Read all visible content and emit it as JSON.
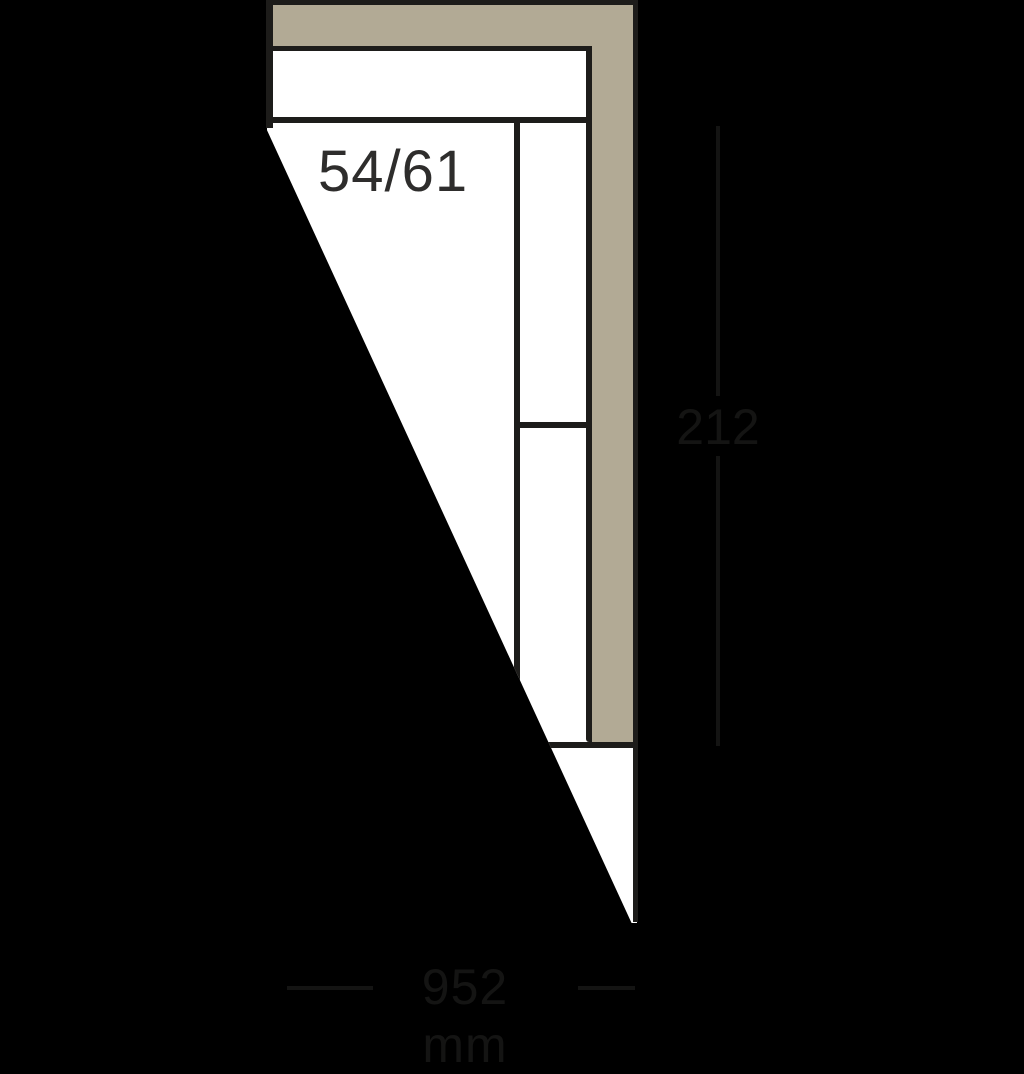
{
  "diagram": {
    "type": "corner-sofa-element-top-view",
    "model_label": "54/61",
    "height_dimension": "212",
    "width_dimension": "952 mm"
  },
  "colors": {
    "bg": "#000000",
    "paper": "#ffffff",
    "beige": "#b2aa95",
    "line": "#1d1c1a",
    "label": "#2e2d2c",
    "faint": "#141413"
  }
}
